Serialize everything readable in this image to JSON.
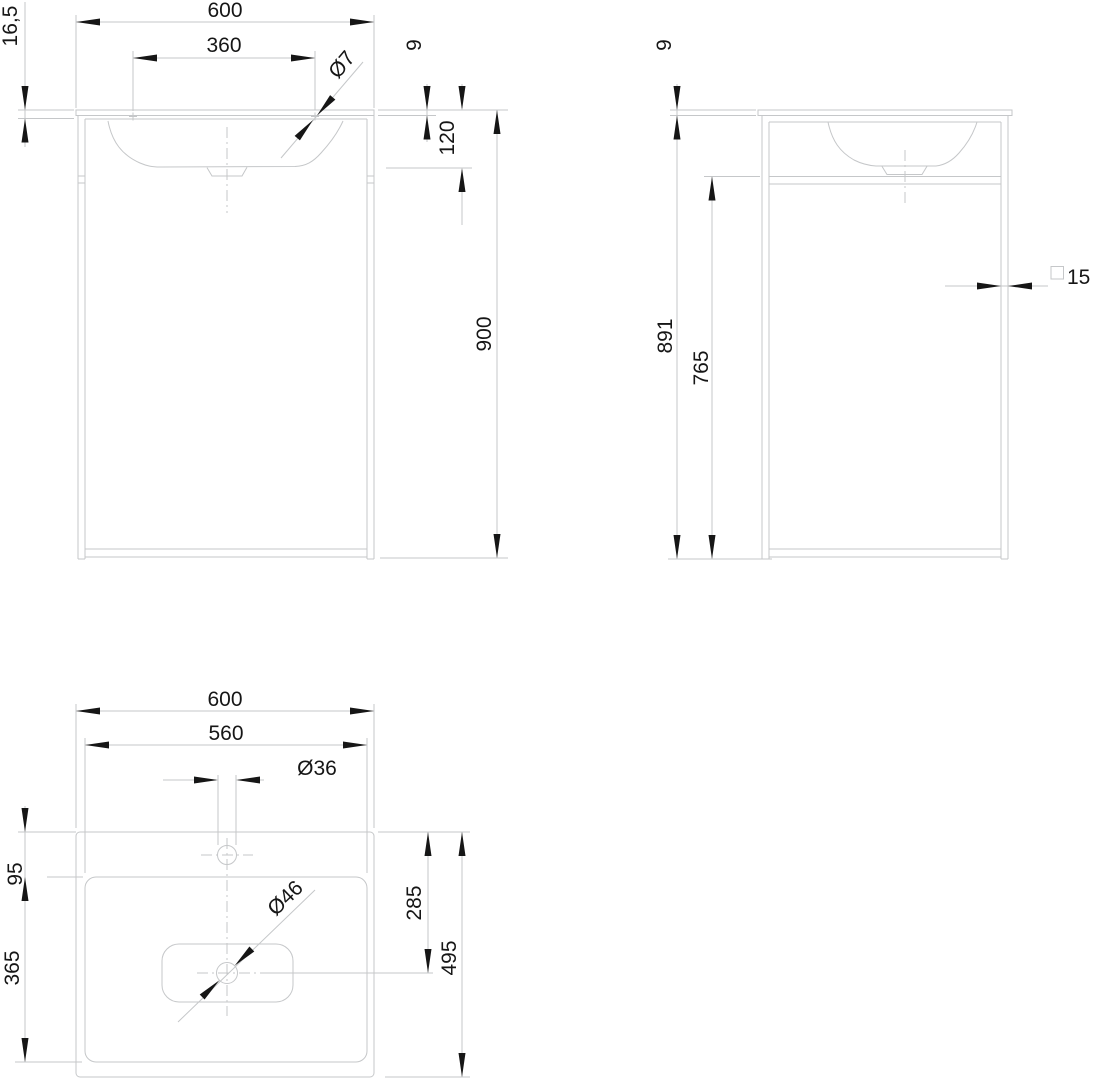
{
  "document": {
    "type": "technical-drawing",
    "subject": "washbasin-with-frame-console",
    "units": "mm"
  },
  "colors": {
    "line": "#c5c7c9",
    "ink": "#161616",
    "background": "#ffffff"
  },
  "views": {
    "front": {
      "label": "front-view",
      "dims": {
        "width": "600",
        "hole_spacing": "360",
        "hole_diameter": "Ø7",
        "top_total_thickness": "16,5",
        "top_thickness": "9",
        "basin_depth": "120",
        "overall_height": "900"
      }
    },
    "side": {
      "label": "side-view",
      "dims": {
        "top_thickness": "9",
        "height_below_top": "891",
        "underframe_clearance": "765",
        "frame_tube_size": "15"
      }
    },
    "plan": {
      "label": "plan-view",
      "dims": {
        "width": "600",
        "cutout_width": "560",
        "faucet_hole_diameter": "Ø36",
        "back_edge_to_cutout": "95",
        "cutout_depth": "365",
        "drain_center_from_back": "285",
        "depth": "495",
        "drain_diameter": "Ø46"
      }
    }
  }
}
